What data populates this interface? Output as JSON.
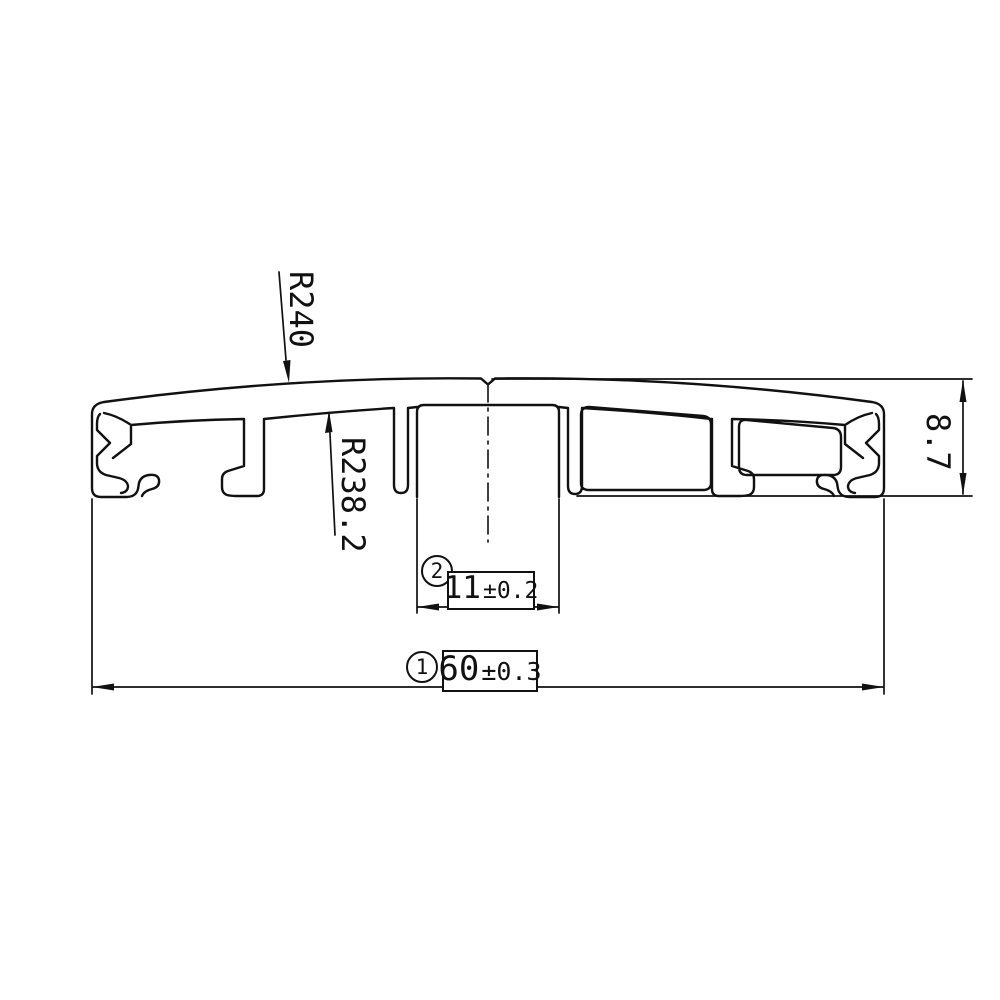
{
  "drawing": {
    "title": "extrusion profile cross-section",
    "labels": {
      "radius_outer": "R240",
      "radius_inner": "R238.2",
      "height": "8.7"
    },
    "dim_center_channel": {
      "index": "2",
      "value": "11",
      "tolerance": "±0.2"
    },
    "dim_overall_width": {
      "index": "1",
      "value": "60",
      "tolerance": "±0.3"
    },
    "colors": {
      "line": "#111111",
      "background": "#ffffff"
    }
  }
}
